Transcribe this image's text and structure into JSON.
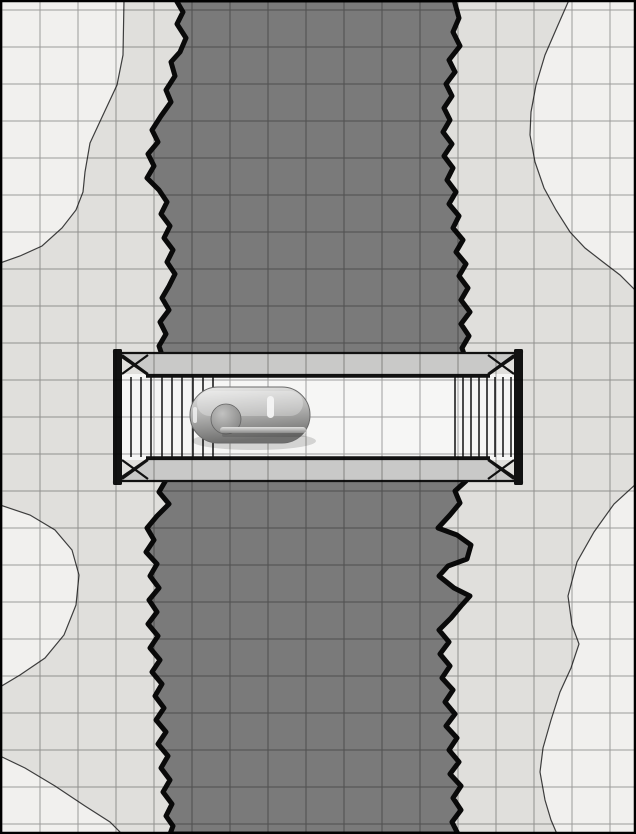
{
  "scene": {
    "name": "chasm-bridge-battle-map",
    "description": "Top-down grid battle map: a dark jagged chasm runs vertically between two pale rock ledges; a plank bridge with stairs at both ends spans the chasm; a gray cart token sits on the deck.",
    "visible_text": [],
    "grid": {
      "spacing_x": 38,
      "spacing_y": 37,
      "offset_x": 2,
      "offset_y": 10,
      "line_opacity": 0.35
    },
    "colors": {
      "frame": "#000000",
      "high_ground": "#f1f0ee",
      "bank": "#e0dfdc",
      "bank_edge_line": "#3d3d3d",
      "chasm": "#7a7a7a",
      "chasm_outline": "#0a0a0a",
      "bridge_rail_fill": "#c9c9c8",
      "bridge_deck": "#f6f6f5",
      "bridge_lines": "#111111",
      "grid": "#000000",
      "cart_light": "#ececeb",
      "cart_mid": "#b4b4b3",
      "cart_dark": "#6f6f6e",
      "wheel_light": "#c2c2c1",
      "wheel_dark": "#7e7e7d",
      "rod_light": "#e0e0df",
      "rod_dark": "#8c8c8b",
      "cart_detail_white": "#f4f4f4"
    },
    "objects": [
      "west-bank",
      "east-bank",
      "chasm",
      "bridge",
      "cart-token"
    ]
  }
}
